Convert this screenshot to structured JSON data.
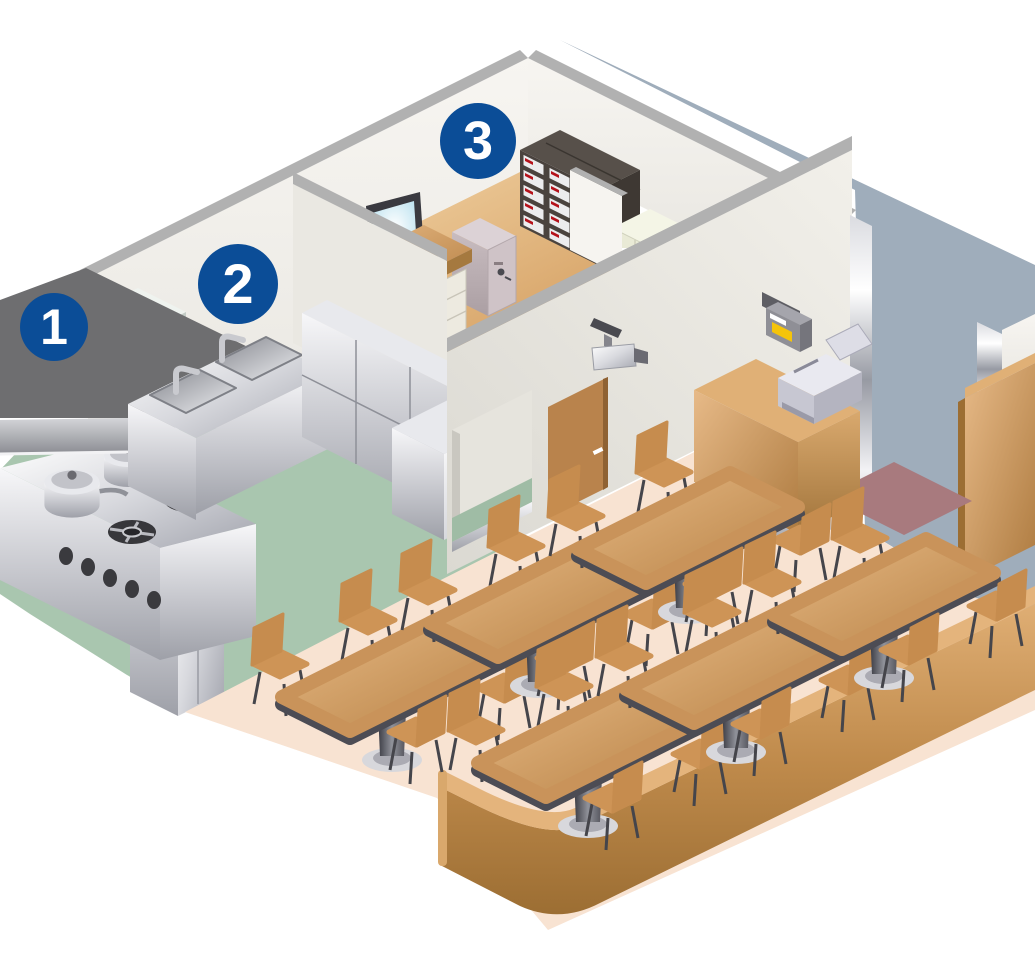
{
  "callouts": [
    {
      "number": "1",
      "target": "kitchen-range-hood"
    },
    {
      "number": "2",
      "target": "kitchen-sink-area"
    },
    {
      "number": "3",
      "target": "office"
    }
  ],
  "colors": {
    "badge_blue": "#0B4D97",
    "badge_text": "#FFFFFF",
    "exterior_ground": "#9FADBB",
    "wall_face": "#F1EFE9",
    "wall_top": "#B1B1B1",
    "kitchen_floor": "#A9C6AF",
    "dining_floor": "#F8E3D2",
    "office_floor": "#E2B577",
    "wood": "#C99055",
    "table_rim": "#4C4C54",
    "pedestal_gray": "#55555D",
    "door_brown": "#B9834C",
    "mat_mauve": "#A87A7E",
    "hood_gray": "#6E6E70",
    "screen_blue": "#BFE4F2",
    "label_yellow": "#F5C40A",
    "handle_red": "#B5121B",
    "safe_gray": "#C9BCC0",
    "cream_cabinet": "#EDEEDC",
    "file_cabinet_dark": "#4A433E",
    "steel_light": "#F4F4F6",
    "steel_dark": "#A7A9B2"
  }
}
